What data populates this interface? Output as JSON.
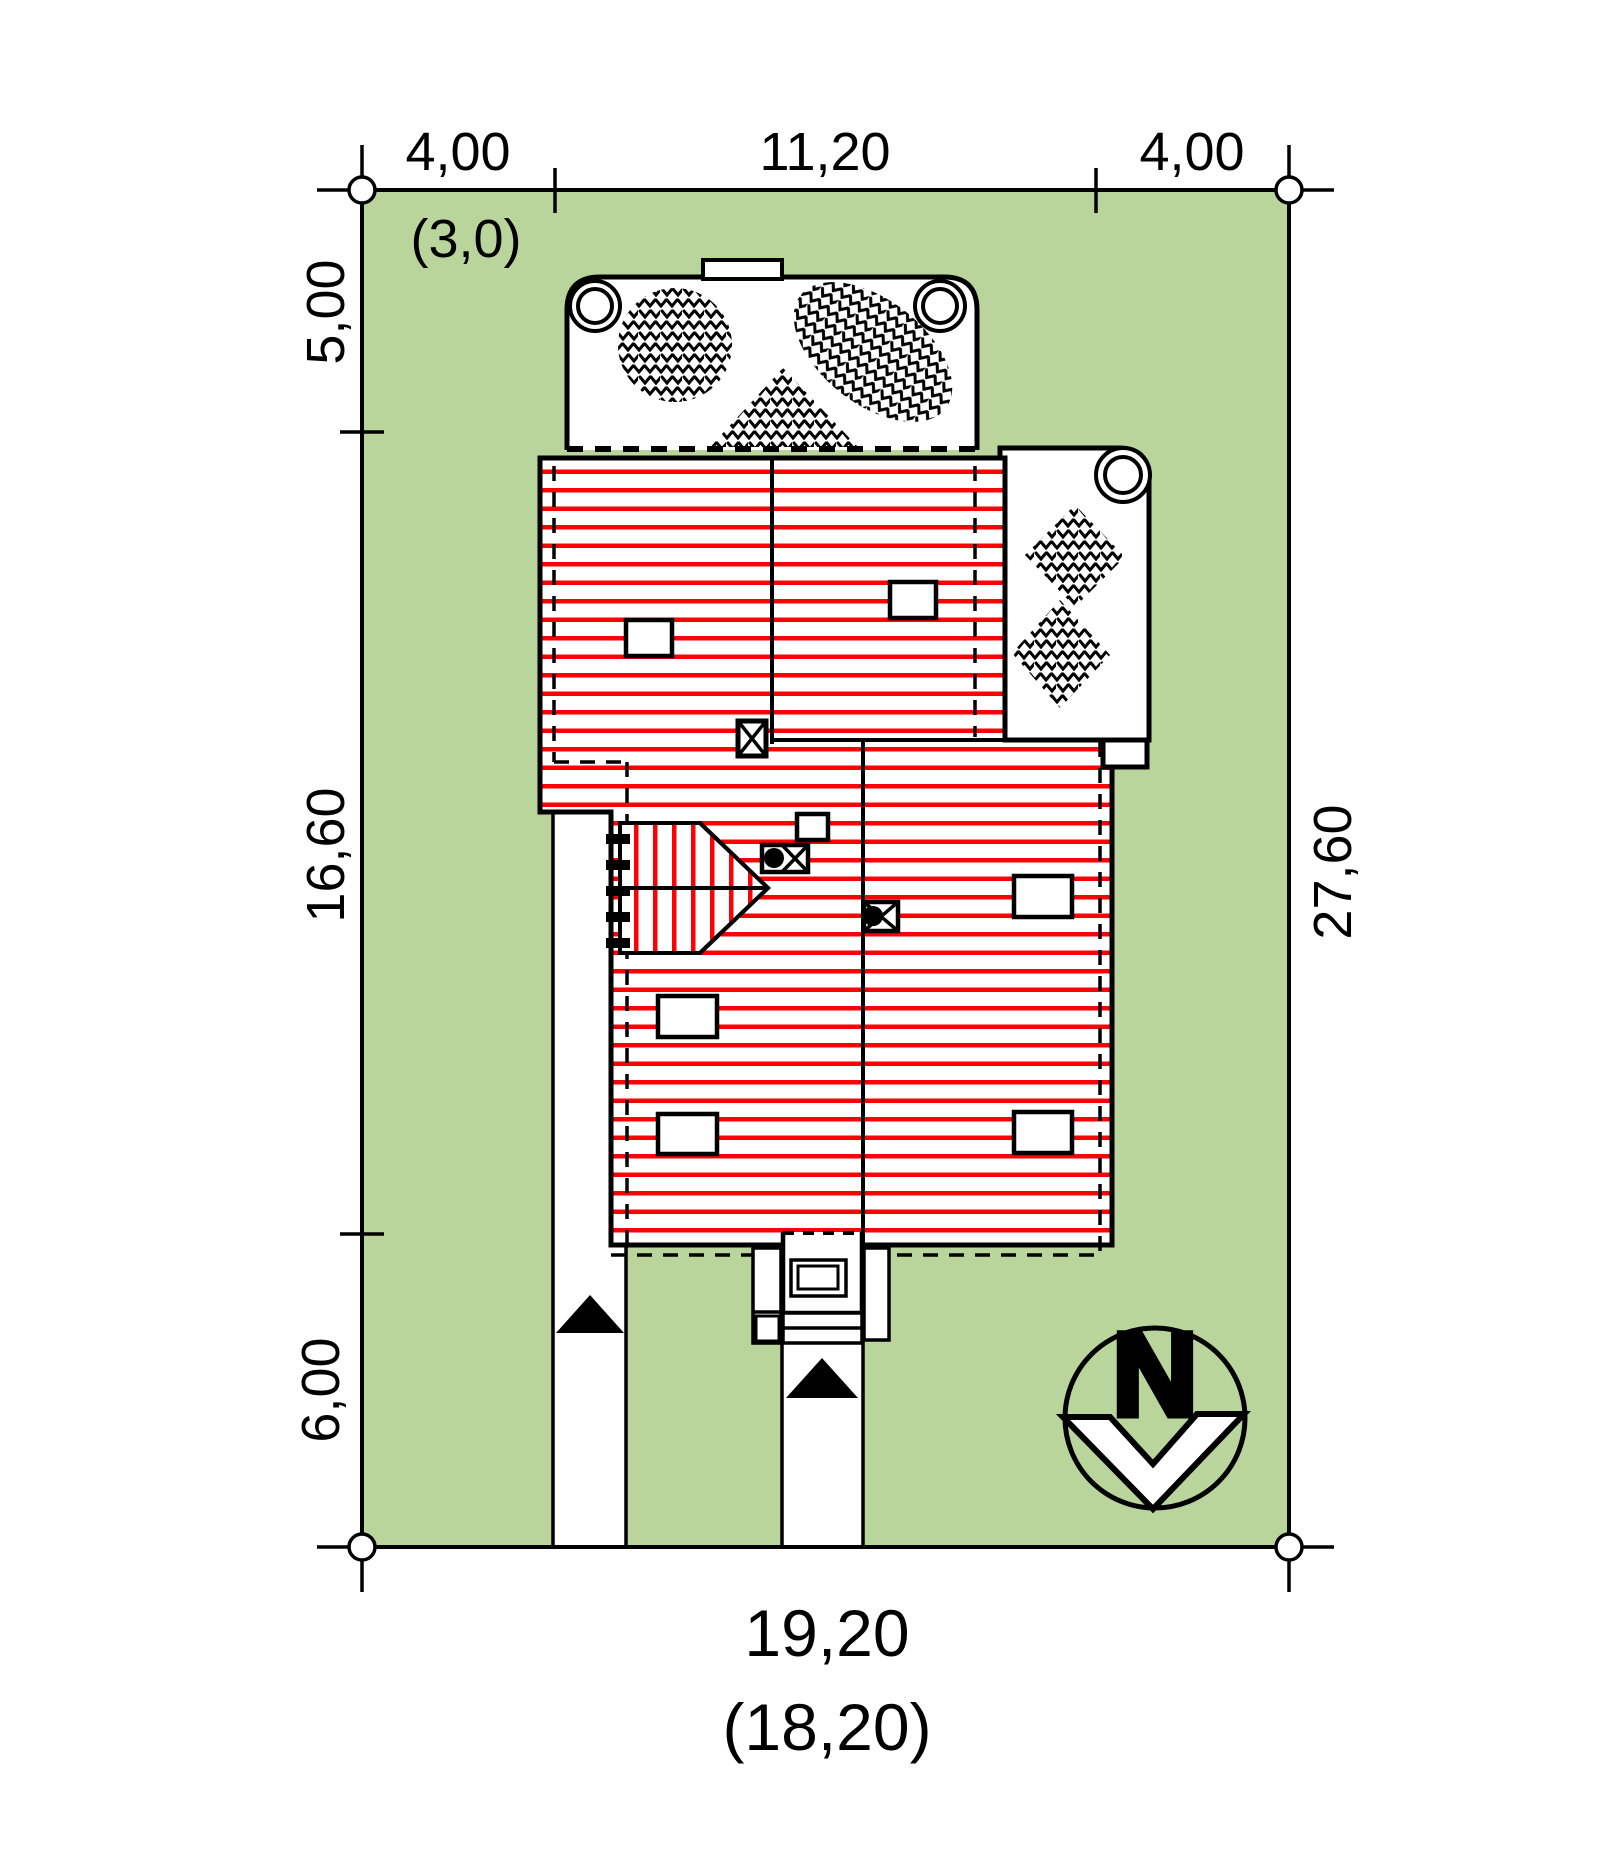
{
  "title": "house-site-plan",
  "dimensions": {
    "top": [
      "4,00",
      "11,20",
      "4,00"
    ],
    "top_secondary": "(3,0)",
    "left": [
      "5,00",
      "16,60",
      "6,00"
    ],
    "right": "27,60",
    "bottom": "19,20",
    "bottom_secondary": "(18,20)"
  },
  "compass": {
    "label": "N"
  },
  "colors": {
    "plot_green": "#b9d59c",
    "roof_hatch_red": "#fb0204",
    "line_black": "#000000",
    "paper_white": "#ffffff"
  },
  "legend_icons": [
    "north-compass",
    "tree-hatch",
    "walkway-arrow",
    "driveway-arrow"
  ]
}
